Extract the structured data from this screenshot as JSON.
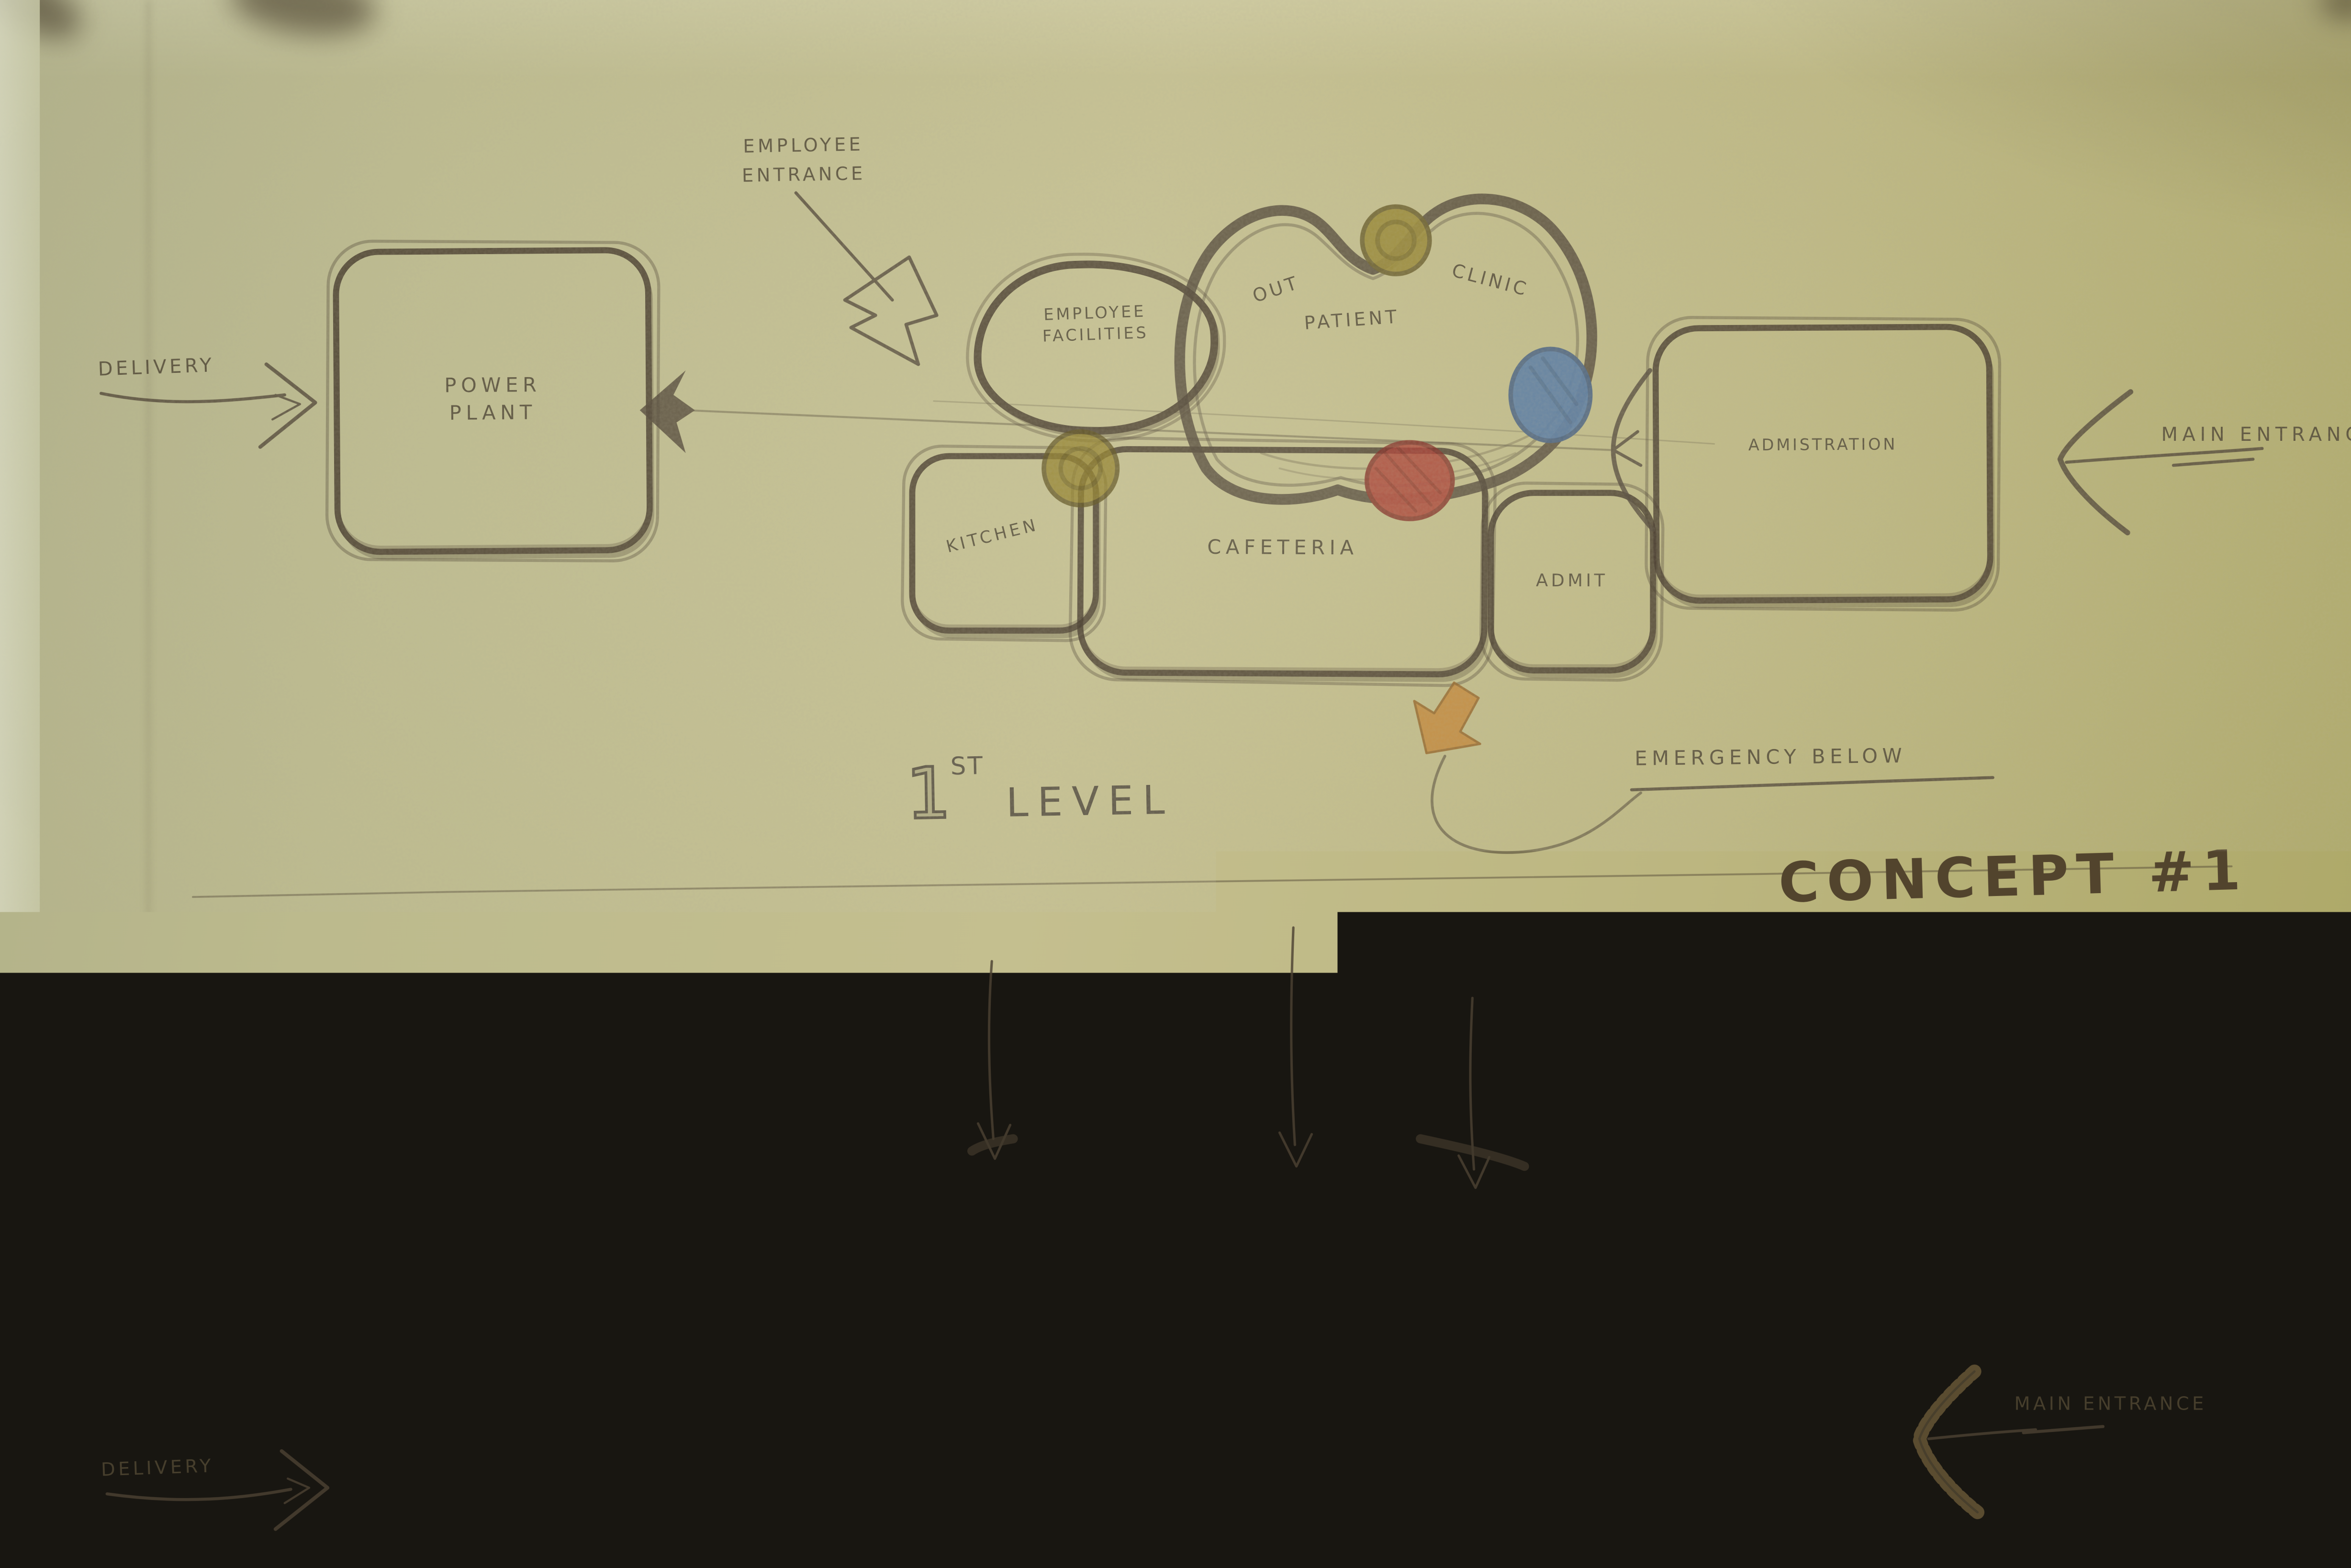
{
  "title": {
    "concept": "CONCEPT #1"
  },
  "level1": {
    "caption": {
      "num": "1",
      "sup": "ST",
      "word": "LEVEL"
    },
    "rooms": {
      "power_plant": "POWER PLANT",
      "employee_facilities": "EMPLOYEE FACILITIES",
      "out_patient": {
        "w1": "OUT",
        "w2": "PATIENT",
        "w3": "CLINIC"
      },
      "kitchen": "KITCHEN",
      "cafeteria": "CAFETERIA",
      "admit": "ADMIT",
      "administration": "ADMISTRATION"
    },
    "annotations": {
      "delivery": "DELIVERY",
      "employee_entrance": "EMPLOYEE ENTRANCE",
      "main_entrance": "MAIN ENTRANCE",
      "emergency_below": "EMERGENCY BELOW"
    }
  },
  "section": {
    "rooms": {
      "inpatient": "INPATIENT",
      "kitchen": "KITCHEN",
      "cafeteria": "CAFETERIA",
      "admitting": "ADMITTING",
      "administration": "ADMINISTRATION",
      "power_plant": "POWER PLANT",
      "supply": "SUPPLY",
      "service": "SERVICE",
      "emergency": "EMERGENCY"
    },
    "flows": {
      "supplies": "SUPPLIES",
      "services": "SERVICES",
      "public": "PUBLIC"
    },
    "annotations": {
      "delivery": "DELIVERY",
      "main_entrance": "MAIN ENTRANCE"
    }
  },
  "colors": {
    "paper": "#beb98c",
    "ink": "#4c4132",
    "node_olive": "#8d7a20",
    "node_blue": "#3f6aa4",
    "node_red": "#a62f26",
    "arrow_orange": "#c08030",
    "ground_tan": "#a3803f"
  }
}
